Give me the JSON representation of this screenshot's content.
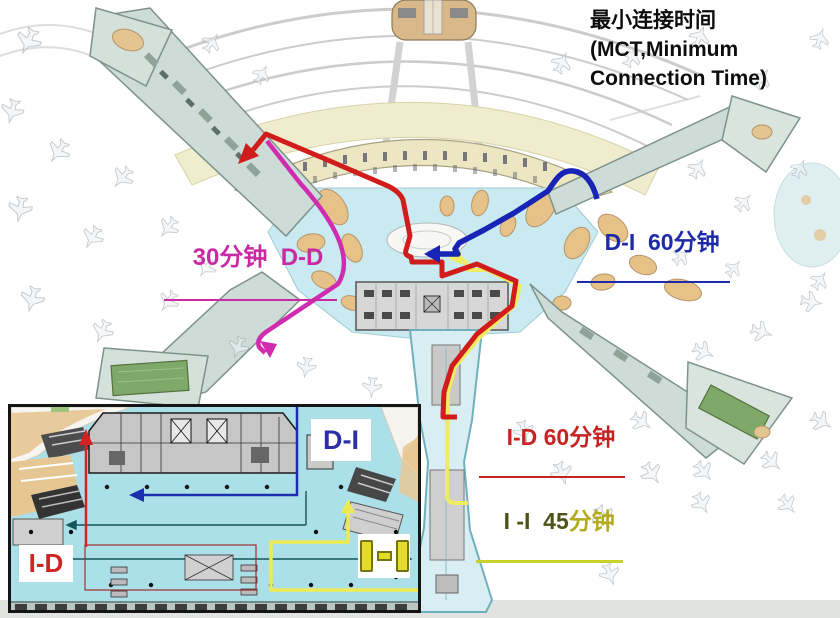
{
  "title": {
    "line1": "最小连接时间",
    "line2": "(MCT,Minimum",
    "line3": "Connection Time)"
  },
  "routes": {
    "dd": {
      "label": "30分钟  D-D",
      "color": "#c92aa2",
      "route_color": "#d12cb0"
    },
    "di": {
      "label": "D-I  60分钟",
      "color": "#1d2ba8",
      "route_color": "#1724b5"
    },
    "id": {
      "label": "I-D 60分钟",
      "color": "#c62424",
      "route_color": "#d11c1c"
    },
    "ii": {
      "label_time": "I -I  45",
      "label_unit": "分钟",
      "color_dark": "#4f5216",
      "color_olive": "#b2ab1c",
      "underline_color": "#c9d22b",
      "route_color": "#efec62"
    }
  },
  "inset": {
    "di_label": "D-I",
    "id_label": "I-D",
    "ii_label": "I-I"
  }
}
